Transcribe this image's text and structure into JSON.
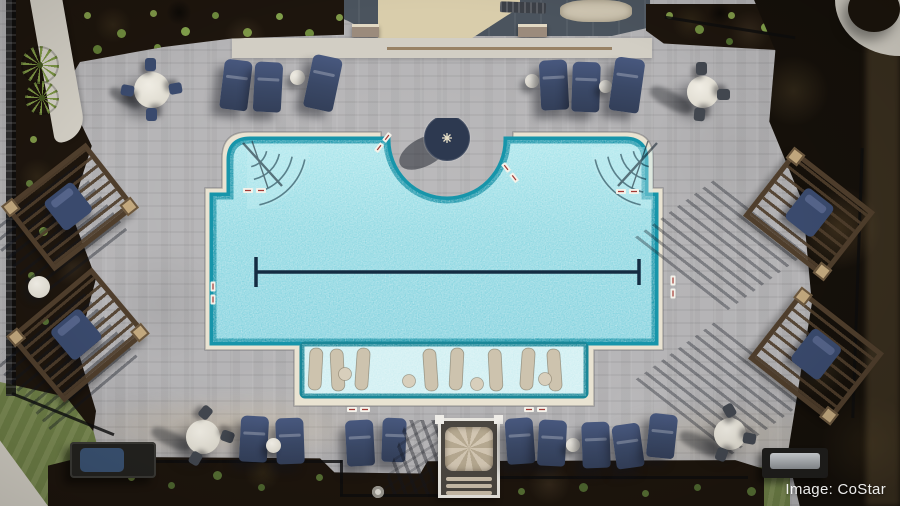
{
  "scene": {
    "type": "aerial-drone-photo",
    "description": "Overhead aerial photo of a community swimming pool: scalloped pool with entry-step wings, center fire-table peninsula, lap lane, tanning ledge with in-water loungers, paver deck, navy chaise lounges, four wood pergolas, round tables, cabana, grills and landscaping",
    "watermark": {
      "text": "Image: CoStar"
    }
  },
  "palette": {
    "paver": "#b3b2b4",
    "coping": "#e9e3d2",
    "water": "#8fd8e2",
    "water-light": "#c2eef2",
    "water-deep": "#1795aa",
    "ledge": "#cdeef1",
    "lane": "#142c42",
    "navy": "#3a4a6d",
    "wood": "#4f3e2c",
    "mulch": "#1d150d",
    "grass": "#6d7e46",
    "concrete": "#d2cec4",
    "roof": "#4b545e",
    "roof-light": "#868d94",
    "patio-tan": "#d9cdab",
    "canopy": "#c9bba6",
    "table-white": "#e8e5dc",
    "dirt": "#15100a"
  }
}
